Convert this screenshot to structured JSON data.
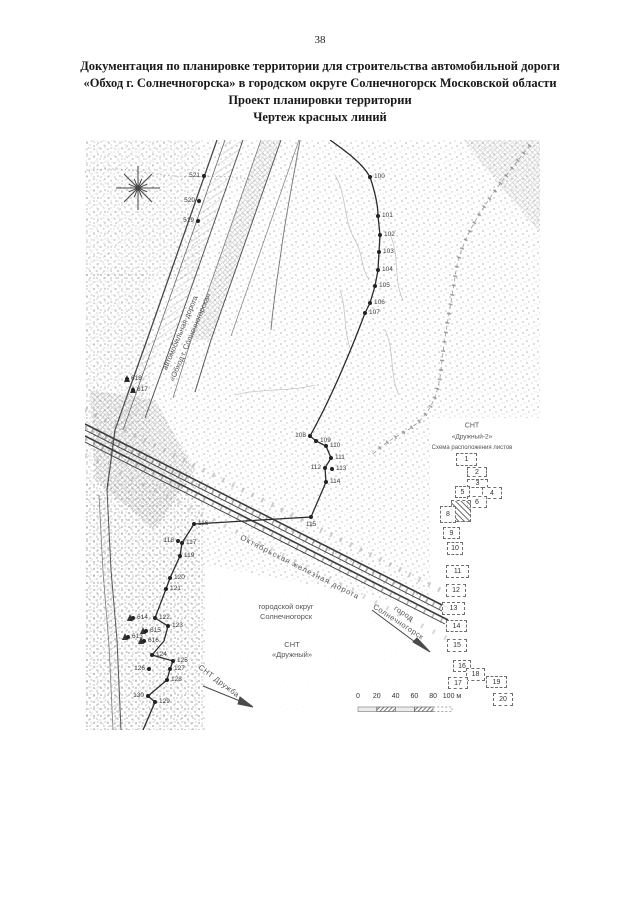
{
  "page": {
    "number": "38"
  },
  "title": {
    "line1": "Документация по планировке территории для строительства автомобильной дороги",
    "line2": "«Обход г. Солнечногорска» в городском округе Солнечногорск Московской области",
    "line3": "Проект планировки территории",
    "line4": "Чертеж красных линий"
  },
  "map": {
    "labels": {
      "road_line1": "автомобильная дорога",
      "road_line2": "«Обход г. Солнечногорска»",
      "railway": "Октябрьская железная дорога",
      "okrug_line1": "городской округ",
      "okrug_line2": "Солнечногорск",
      "snt_druzhny_line1": "СНТ",
      "snt_druzhny_line2": "«Дружный»",
      "city_line1": "город",
      "city_line2": "Солнечногорск",
      "snt_druzhba": "СНТ Дружба"
    },
    "points": [
      {
        "n": "100",
        "x": 285,
        "y": 37,
        "s": "r"
      },
      {
        "n": "101",
        "x": 293,
        "y": 76,
        "s": "r"
      },
      {
        "n": "102",
        "x": 295,
        "y": 95,
        "s": "r"
      },
      {
        "n": "103",
        "x": 294,
        "y": 112,
        "s": "r"
      },
      {
        "n": "104",
        "x": 293,
        "y": 130,
        "s": "r"
      },
      {
        "n": "105",
        "x": 290,
        "y": 146,
        "s": "r"
      },
      {
        "n": "106",
        "x": 285,
        "y": 163,
        "s": "r"
      },
      {
        "n": "107",
        "x": 280,
        "y": 173,
        "s": "r"
      },
      {
        "n": "108",
        "x": 225,
        "y": 296,
        "s": "l"
      },
      {
        "n": "109",
        "x": 231,
        "y": 301,
        "s": "r"
      },
      {
        "n": "110",
        "x": 241,
        "y": 306,
        "s": "r"
      },
      {
        "n": "111",
        "x": 246,
        "y": 318,
        "s": "r"
      },
      {
        "n": "112",
        "x": 240,
        "y": 328,
        "s": "l"
      },
      {
        "n": "113",
        "x": 247,
        "y": 329,
        "s": "r"
      },
      {
        "n": "114",
        "x": 241,
        "y": 342,
        "s": "r"
      },
      {
        "n": "115",
        "x": 226,
        "y": 377,
        "s": "b"
      },
      {
        "n": "116",
        "x": 109,
        "y": 384,
        "s": "r"
      },
      {
        "n": "117",
        "x": 97,
        "y": 403,
        "s": "r"
      },
      {
        "n": "118",
        "x": 93,
        "y": 401,
        "s": "l"
      },
      {
        "n": "119",
        "x": 95,
        "y": 416,
        "s": "r"
      },
      {
        "n": "120",
        "x": 85,
        "y": 438,
        "s": "r"
      },
      {
        "n": "121",
        "x": 81,
        "y": 449,
        "s": "r"
      },
      {
        "n": "122",
        "x": 70,
        "y": 478,
        "s": "r"
      },
      {
        "n": "123",
        "x": 83,
        "y": 486,
        "s": "r"
      },
      {
        "n": "124",
        "x": 67,
        "y": 515,
        "s": "r"
      },
      {
        "n": "125",
        "x": 88,
        "y": 521,
        "s": "r"
      },
      {
        "n": "126",
        "x": 64,
        "y": 529,
        "s": "l"
      },
      {
        "n": "127",
        "x": 85,
        "y": 529,
        "s": "r"
      },
      {
        "n": "128",
        "x": 82,
        "y": 540,
        "s": "r"
      },
      {
        "n": "129",
        "x": 70,
        "y": 562,
        "s": "r"
      },
      {
        "n": "130",
        "x": 63,
        "y": 556,
        "s": "l"
      },
      {
        "n": "521",
        "x": 119,
        "y": 36,
        "s": "l"
      },
      {
        "n": "520",
        "x": 114,
        "y": 61,
        "s": "l"
      },
      {
        "n": "519",
        "x": 113,
        "y": 81,
        "s": "l"
      },
      {
        "n": "618",
        "x": 42,
        "y": 239,
        "s": "r"
      },
      {
        "n": "617",
        "x": 48,
        "y": 250,
        "s": "r"
      },
      {
        "n": "614",
        "x": 48,
        "y": 478,
        "s": "r"
      },
      {
        "n": "615",
        "x": 61,
        "y": 491,
        "s": "r"
      },
      {
        "n": "613",
        "x": 43,
        "y": 497,
        "s": "r"
      },
      {
        "n": "616",
        "x": 59,
        "y": 501,
        "s": "r"
      }
    ]
  },
  "legend": {
    "title_line1": "СНТ",
    "title_line2": "«Дружный-2»",
    "subtitle": "Схема расположения листов",
    "sheets": [
      {
        "num": "1",
        "x": 371,
        "y": 313,
        "w": 21,
        "h": 13
      },
      {
        "num": "2",
        "x": 382,
        "y": 327,
        "w": 20,
        "h": 10
      },
      {
        "num": "3",
        "x": 382,
        "y": 339,
        "w": 21,
        "h": 9
      },
      {
        "num": "5",
        "x": 370,
        "y": 346,
        "w": 15,
        "h": 12
      },
      {
        "num": "4",
        "x": 397,
        "y": 347,
        "w": 20,
        "h": 12
      },
      {
        "num": "6",
        "x": 382,
        "y": 356,
        "w": 20,
        "h": 12
      },
      {
        "num": "",
        "x": 366,
        "y": 360,
        "w": 20,
        "h": 22,
        "hatched": true
      },
      {
        "num": "8",
        "x": 355,
        "y": 366,
        "w": 16,
        "h": 17
      },
      {
        "num": "9",
        "x": 358,
        "y": 387,
        "w": 17,
        "h": 12
      },
      {
        "num": "10",
        "x": 362,
        "y": 402,
        "w": 16,
        "h": 13
      },
      {
        "num": "11",
        "x": 361,
        "y": 425,
        "w": 23,
        "h": 13
      },
      {
        "num": "12",
        "x": 361,
        "y": 444,
        "w": 20,
        "h": 13
      },
      {
        "num": "13",
        "x": 357,
        "y": 462,
        "w": 23,
        "h": 13
      },
      {
        "num": "14",
        "x": 361,
        "y": 480,
        "w": 21,
        "h": 12
      },
      {
        "num": "15",
        "x": 362,
        "y": 499,
        "w": 20,
        "h": 13
      },
      {
        "num": "16",
        "x": 368,
        "y": 520,
        "w": 18,
        "h": 12
      },
      {
        "num": "18",
        "x": 381,
        "y": 528,
        "w": 19,
        "h": 13
      },
      {
        "num": "17",
        "x": 363,
        "y": 537,
        "w": 20,
        "h": 12
      },
      {
        "num": "19",
        "x": 401,
        "y": 536,
        "w": 21,
        "h": 12
      },
      {
        "num": "20",
        "x": 408,
        "y": 553,
        "w": 20,
        "h": 13
      }
    ]
  },
  "scale_bar": {
    "ticks": [
      "0",
      "20",
      "40",
      "60",
      "80",
      "100 м"
    ]
  }
}
